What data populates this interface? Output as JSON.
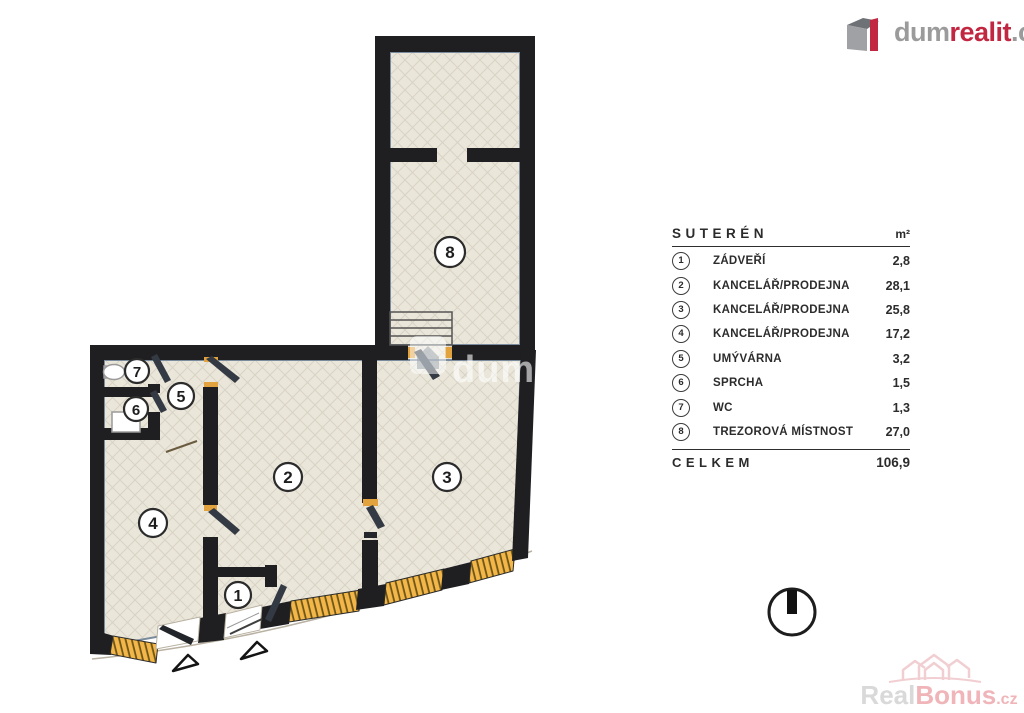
{
  "brand": {
    "prefix": "dum",
    "accent": "realit",
    "suffix": ".cz"
  },
  "legend": {
    "title": "SUTERÉN",
    "unit": "m²",
    "rows": [
      {
        "num": "1",
        "name": "ZÁDVEŘÍ",
        "area": "2,8"
      },
      {
        "num": "2",
        "name": "KANCELÁŘ/PRODEJNA",
        "area": "28,1"
      },
      {
        "num": "3",
        "name": "KANCELÁŘ/PRODEJNA",
        "area": "25,8"
      },
      {
        "num": "4",
        "name": "KANCELÁŘ/PRODEJNA",
        "area": "17,2"
      },
      {
        "num": "5",
        "name": "UMÝVÁRNA",
        "area": "3,2"
      },
      {
        "num": "6",
        "name": "SPRCHA",
        "area": "1,5"
      },
      {
        "num": "7",
        "name": "WC",
        "area": "1,3"
      },
      {
        "num": "8",
        "name": "TREZOROVÁ MÍSTNOST",
        "area": "27,0"
      }
    ],
    "total_label": "CELKEM",
    "total_value": "106,9"
  },
  "plan": {
    "room_numbers": [
      "1",
      "2",
      "3",
      "4",
      "5",
      "6",
      "7",
      "8"
    ],
    "watermark_text": "dumreal"
  },
  "footer_watermark": {
    "prefix": "Real",
    "accent": "Bonus",
    "suffix": ".cz"
  },
  "colors": {
    "brand_red": "#c22742",
    "wall": "#1f1f22",
    "floor": "#eae6da",
    "window_band": "#f2b649",
    "watermark_pink": "#f0b5b9"
  }
}
